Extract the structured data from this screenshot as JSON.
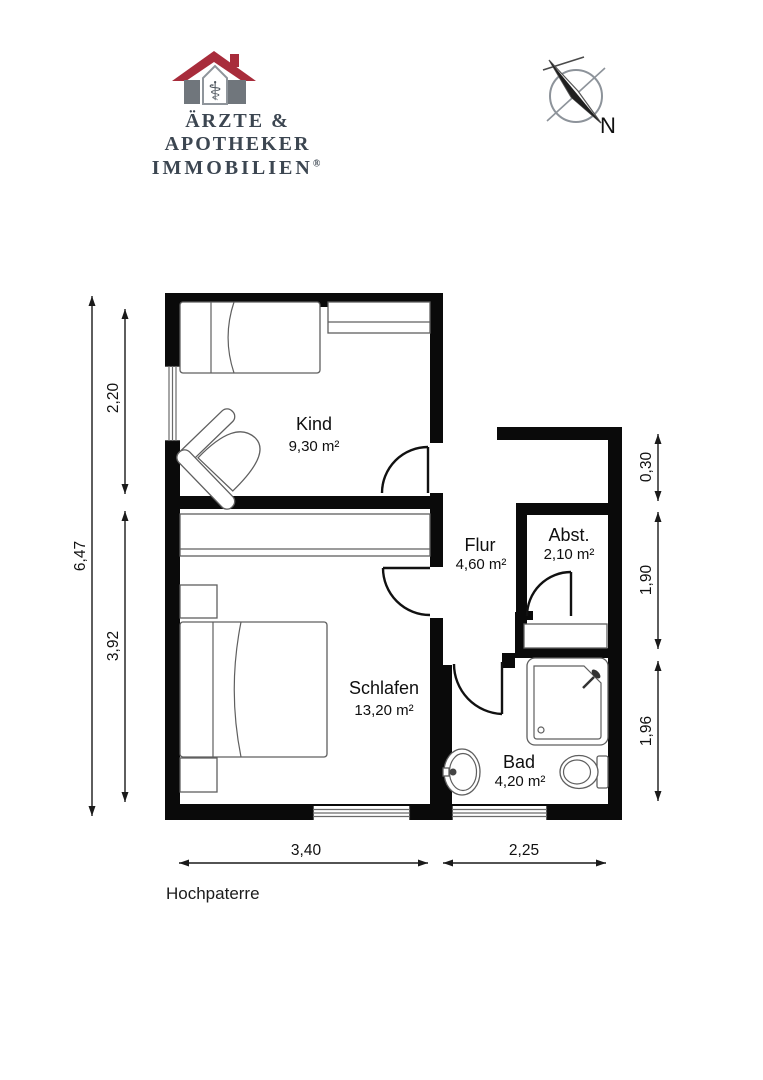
{
  "header": {
    "logo": {
      "line1": "ÄRZTE & APOTHEKER",
      "line2": "IMMOBILIEN",
      "registered": "®",
      "pharmacy_symbol": "⚕",
      "colors": {
        "roof": "#a82c3b",
        "pillar": "#70767c",
        "tower_stroke": "#8f959b",
        "symbol": "#4e565e",
        "text": "#3c4651"
      }
    },
    "compass": {
      "north_label": "N"
    }
  },
  "floorplan": {
    "title": "Hochpaterre",
    "rooms": [
      {
        "name": "Kind",
        "area": "9,30 m²"
      },
      {
        "name": "Schlafen",
        "area": "13,20 m²"
      },
      {
        "name": "Flur",
        "area": "4,60 m²"
      },
      {
        "name": "Abst.",
        "area": "2,10 m²"
      },
      {
        "name": "Bad",
        "area": "4,20 m²"
      }
    ],
    "dimensions": {
      "left_total": "6,47",
      "left_kind": "2,20",
      "left_schlafen": "3,92",
      "right_top": "0,30",
      "right_abst": "1,90",
      "right_bad": "1,96",
      "bottom_schlafen": "3,40",
      "bottom_bad": "2,25"
    },
    "wall_color": "#0a0a0a"
  }
}
